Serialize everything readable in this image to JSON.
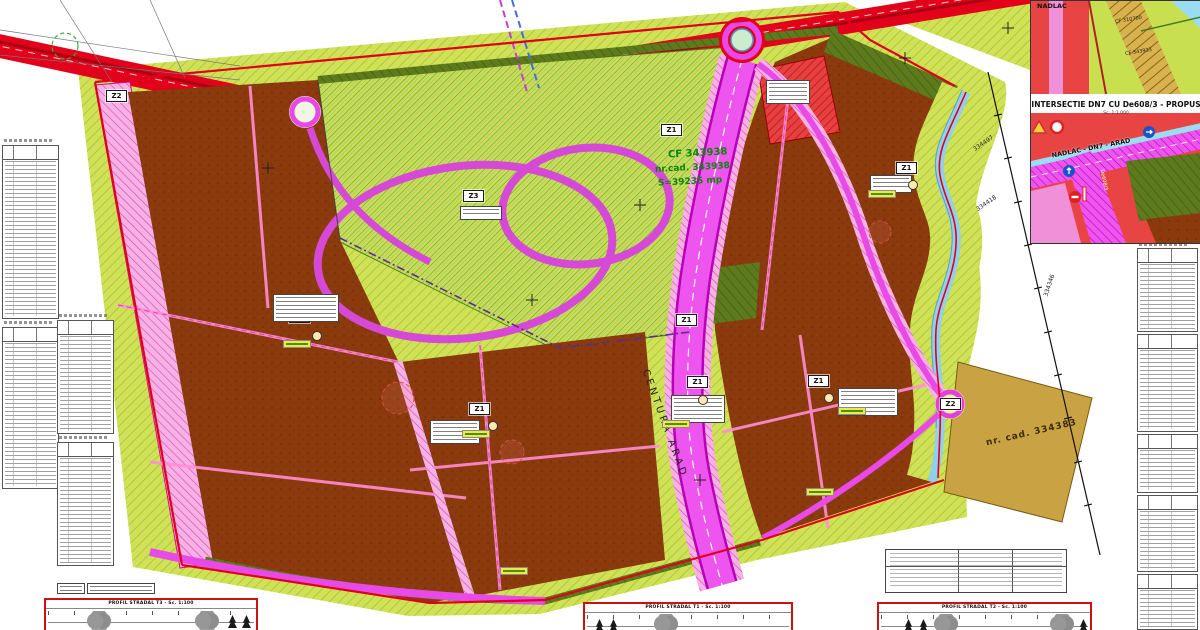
{
  "map": {
    "zone_labels": [
      {
        "text": "Z2"
      },
      {
        "text": "Z3"
      },
      {
        "text": "Z1"
      },
      {
        "text": "Z1"
      },
      {
        "text": "Z1"
      },
      {
        "text": "Z1"
      },
      {
        "text": "Z1"
      },
      {
        "text": "Z2"
      },
      {
        "text": "Z1"
      },
      {
        "text": "Z1"
      }
    ],
    "central_parcel": {
      "cf": "CF 343938",
      "nr_cad": "nr.cad. 343938",
      "area": "S=39235 mp"
    },
    "road_label": "CENTURA ARAD",
    "right_parcel": "nr. cad. 334383",
    "boundary_numbers": [
      "334497",
      "334418",
      "334346"
    ]
  },
  "inset": {
    "title": "INTERSECTIE DN7 CU De608/3 - PROPUS",
    "scale": "Sc. 1:1 000",
    "road_label": "NADLAC - DN7 - ARAD",
    "top_road": "NADLAC",
    "cf_1": "CF 310700",
    "cf_2": "CF 343933",
    "small_road": "De608/3"
  },
  "profiles": [
    {
      "title": "PROFIL STRADAL T3 - Sc. 1:100"
    },
    {
      "title": "PROFIL STRADAL T1 - Sc. 1:100"
    },
    {
      "title": "PROFIL STRADAL T2 - Sc. 1:100"
    }
  ]
}
